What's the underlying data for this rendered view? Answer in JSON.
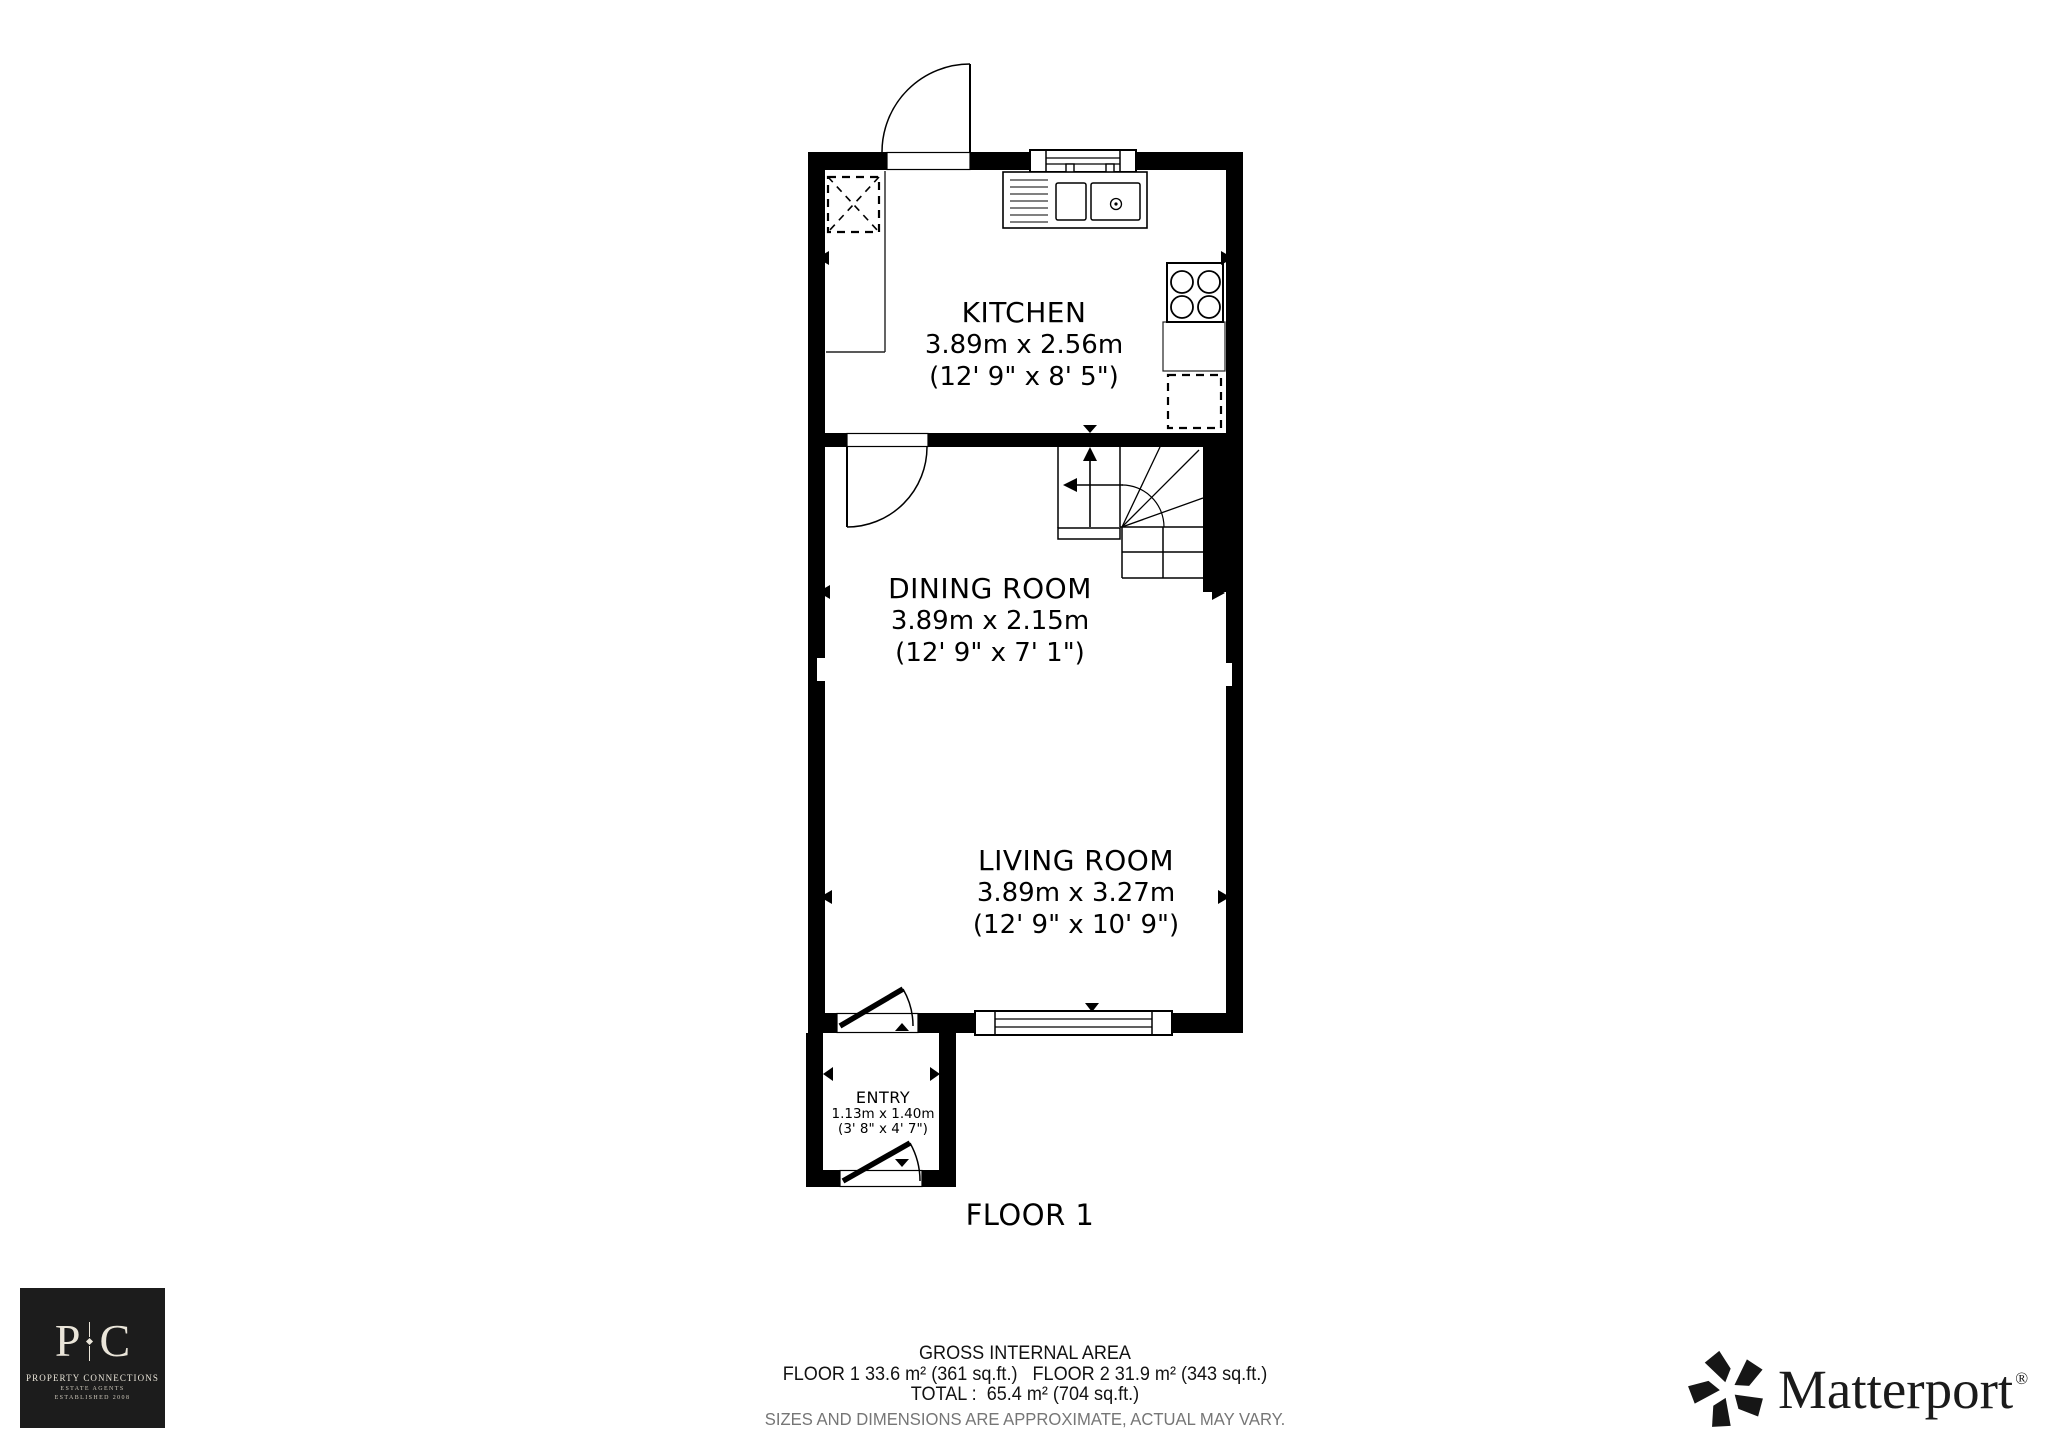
{
  "plan": {
    "floor_label": "FLOOR 1",
    "rooms": [
      {
        "name": "KITCHEN",
        "metric": "3.89m x 2.56m",
        "imperial": "(12' 9\" x 8' 5\")"
      },
      {
        "name": "DINING ROOM",
        "metric": "3.89m x 2.15m",
        "imperial": "(12' 9\" x 7' 1\")"
      },
      {
        "name": "LIVING ROOM",
        "metric": "3.89m x 3.27m",
        "imperial": "(12' 9\" x 10' 9\")"
      },
      {
        "name": "ENTRY",
        "metric": "1.13m x 1.40m",
        "imperial": "(3' 8\" x 4' 7\")"
      }
    ],
    "colors": {
      "wall": "#000000",
      "line": "#1a1a1a"
    }
  },
  "footer": {
    "gross_title": "GROSS INTERNAL AREA",
    "floors_line": "FLOOR 1 33.6 m² (361 sq.ft.)   FLOOR 2 31.9 m² (343 sq.ft.)",
    "total_line": "TOTAL :  65.4 m² (704 sq.ft.)",
    "disclaimer": "SIZES AND DIMENSIONS ARE APPROXIMATE, ACTUAL MAY VARY."
  },
  "agency_logo": {
    "initial_left": "P",
    "initial_right": "C",
    "name": "PROPERTY CONNECTIONS",
    "sub1": "ESTATE AGENTS",
    "sub2": "ESTABLISHED 2008",
    "bg": "#1c1c1c",
    "fg": "#eae5d9"
  },
  "matterport_logo": {
    "brand": "Matterport",
    "registered_mark": "®"
  }
}
